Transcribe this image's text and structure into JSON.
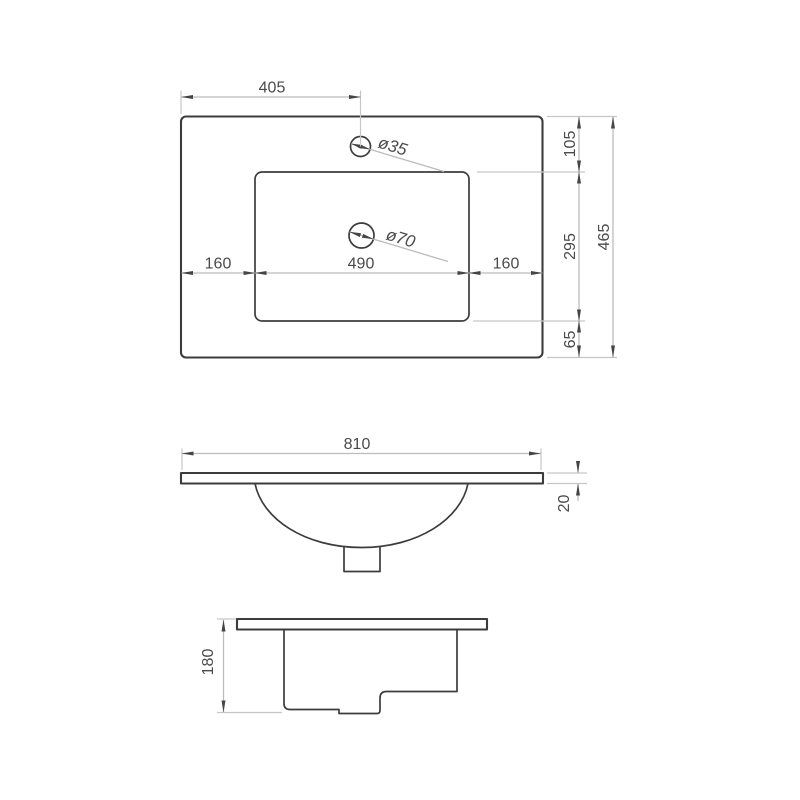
{
  "drawing": {
    "title": "Washbasin countertop technical drawing",
    "top_view": {
      "faucet_offset": "405",
      "faucet_hole_dia": "ø35",
      "drain_hole_dia": "ø70",
      "margin_left": "160",
      "basin_width": "490",
      "margin_right": "160",
      "margin_top": "105",
      "basin_depth": "295",
      "margin_bottom": "65",
      "total_depth": "465"
    },
    "front_view": {
      "total_width": "810",
      "top_thickness": "20"
    },
    "side_view": {
      "total_height": "180"
    },
    "colors": {
      "object_line": "#3c3c3c",
      "dimension_line": "#bcbcbc",
      "text": "#4a4a4a",
      "background": "#ffffff"
    }
  }
}
